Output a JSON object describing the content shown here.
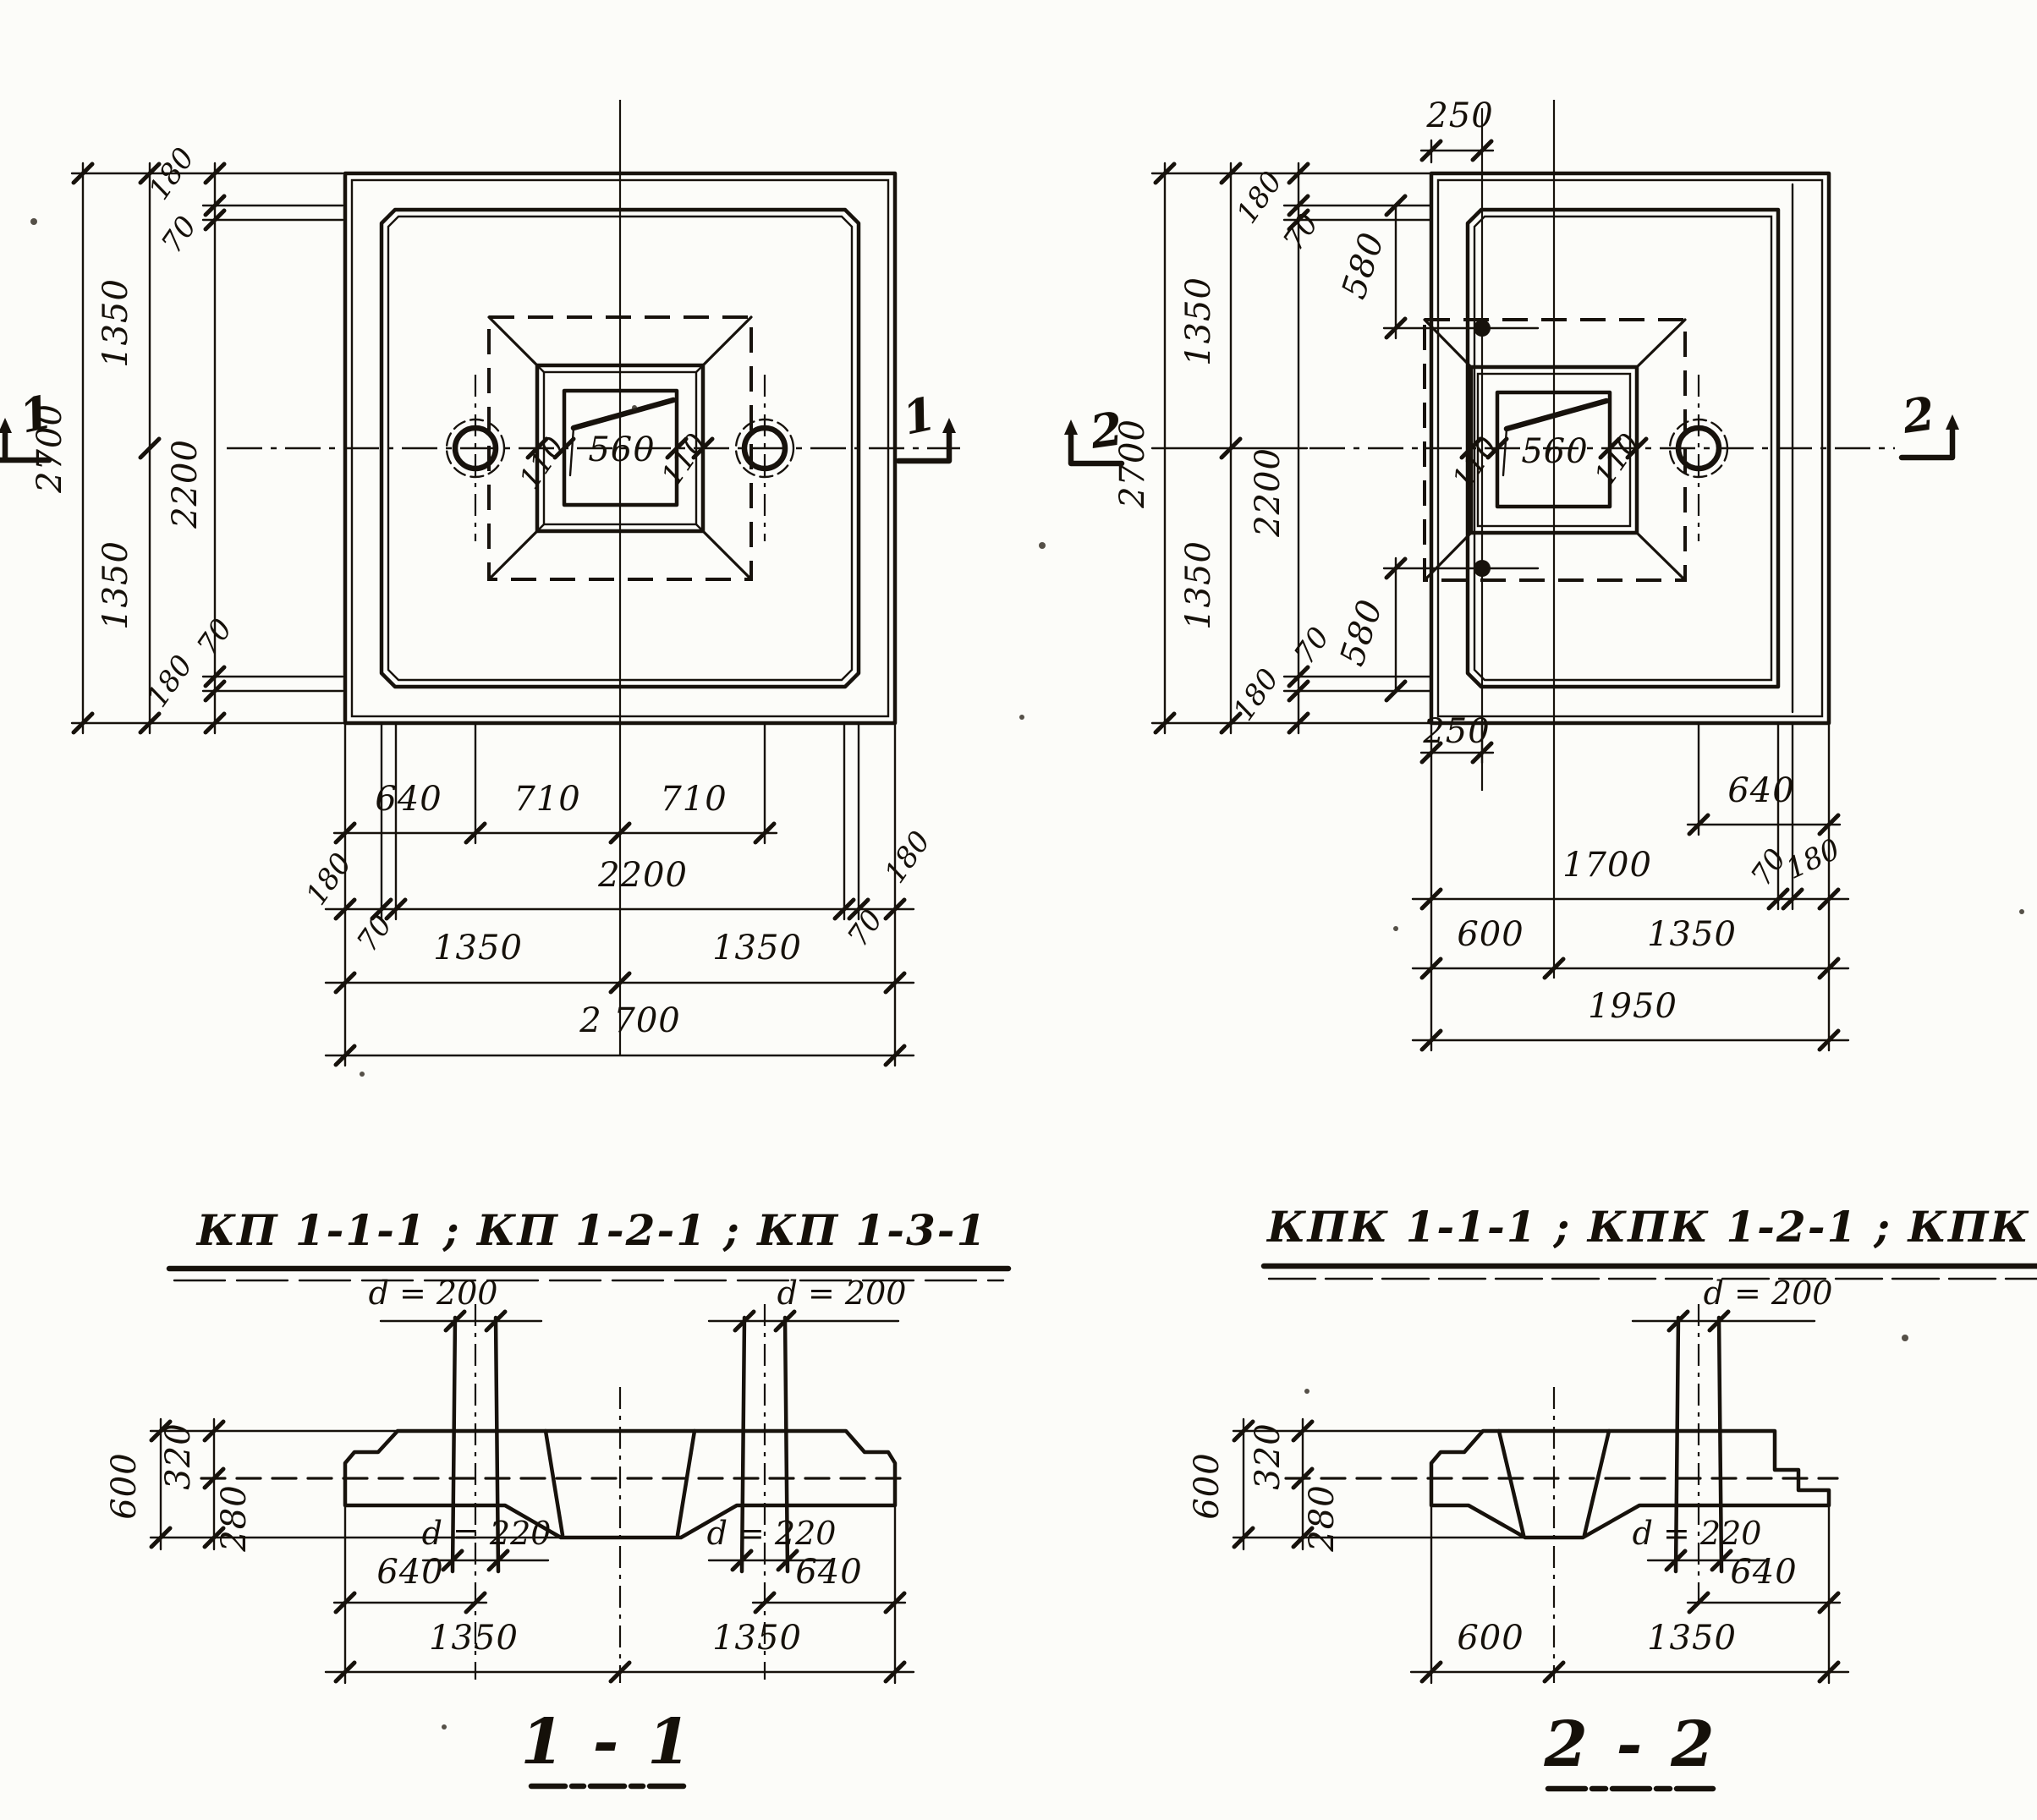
{
  "titles": {
    "plan_left": "КП 1-1-1 ; КП 1-2-1 ; КП 1-3-1",
    "plan_right": "КПК 1-1-1 ; КПК 1-2-1 ; КПК 1-3-1",
    "section_left": "1 - 1",
    "section_right": "2 - 2"
  },
  "section_markers": {
    "s1": "1",
    "s2": "2"
  },
  "plan_kp": {
    "side": {
      "overall": "2700",
      "half_top": "1350",
      "half_bottom": "1350",
      "inner": "2200",
      "edge_top": "180",
      "rim_top": "70",
      "rim_bottom": "70",
      "edge_bottom": "180"
    },
    "cup": {
      "wall_left": "110",
      "socket": "560",
      "wall_right": "110"
    },
    "bottom": {
      "b640": "640",
      "b710l": "710",
      "b710r": "710",
      "b180l": "180",
      "b2200": "2200",
      "b180r": "180",
      "b70l": "70",
      "b70r": "70",
      "b1350l": "1350",
      "b1350r": "1350",
      "b2700": "2 700"
    }
  },
  "plan_kpk": {
    "top_dim": "250",
    "side": {
      "overall": "2700",
      "half_top": "1350",
      "half_bottom": "1350",
      "inner": "2200"
    },
    "corner_top": {
      "edge": "180",
      "rim": "70",
      "offset": "580"
    },
    "corner_bottom": {
      "edge": "180",
      "rim": "70",
      "offset": "580"
    },
    "cup": {
      "wall_left": "110",
      "socket": "560",
      "wall_right": "110"
    },
    "bottom": {
      "b250": "250",
      "b640": "640",
      "b1700": "1700",
      "b70": "70",
      "b180": "180",
      "b600": "600",
      "b1350": "1350",
      "b1950": "1950"
    }
  },
  "section_1_1": {
    "d_top_left": "d = 200",
    "d_top_right": "d = 200",
    "d_bot_left": "d = 220",
    "d_bot_right": "d = 220",
    "h600": "600",
    "h320": "320",
    "h280": "280",
    "b640l": "640",
    "b640r": "640",
    "b1350l": "1350",
    "b1350r": "1350"
  },
  "section_2_2": {
    "d_top": "d = 200",
    "d_bot": "d = 220",
    "h600": "600",
    "h320": "320",
    "h280": "280",
    "b640": "640",
    "b600": "600",
    "b1350": "1350"
  }
}
